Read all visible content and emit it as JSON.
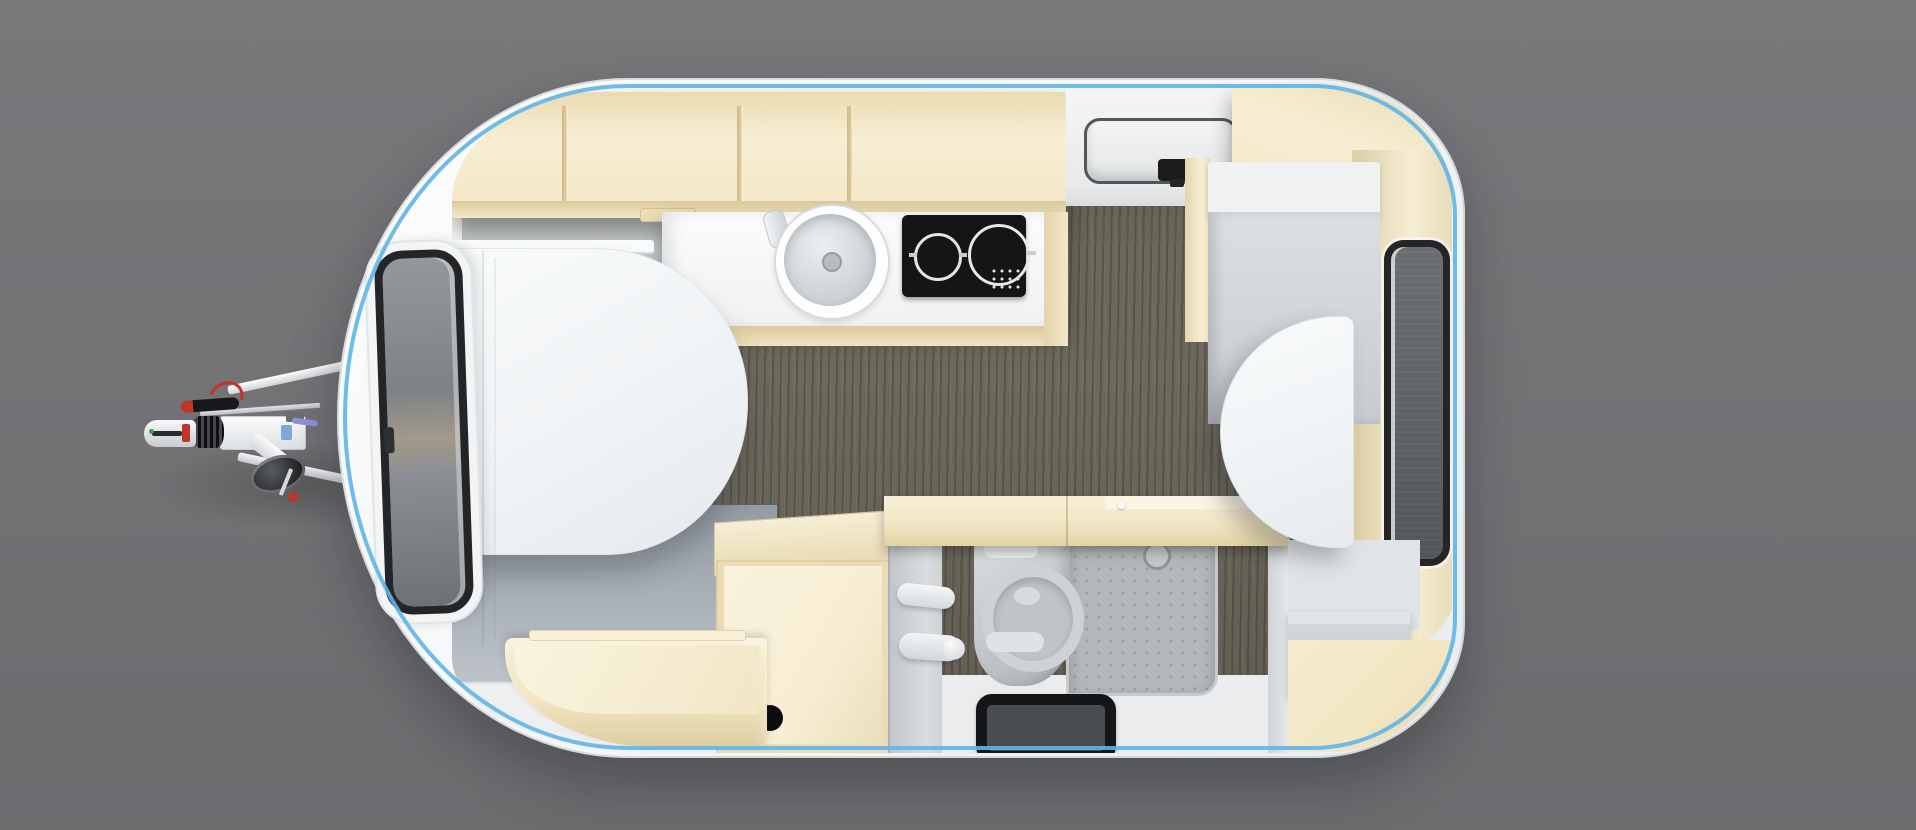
{
  "scene": {
    "title": "Top-down 3D render of a single-axle travel caravan interior floor plan",
    "view": "bird's-eye cutaway",
    "background": "plain gray studio backdrop"
  },
  "colors": {
    "background": "#727275",
    "background_top": "#78787b",
    "background_bottom": "#6c6c6f",
    "body": "#f5f7f8",
    "body_shade": "#e9ecee",
    "trim_blue": "#5fb5e8",
    "cabinet_cream": "#f2e6c3",
    "cabinet_light": "#f7eed4",
    "cabinet_dark": "#dcc99c",
    "floor_wood": "#6b665a",
    "wall_gray": "#c2c6ca",
    "under_bed_gray": "#939ba4",
    "furniture_white": "#f0f3f5",
    "stove_black": "#141517",
    "window_frame": "#232527",
    "window_mesh": "#5e6165",
    "fixture_gray": "#c3c8cc",
    "shower_gray": "#b3b6ba",
    "mat_black": "#141618",
    "accent_red": "#c2342a",
    "label_blue": "#7fa8d9"
  },
  "parts": {
    "caravan_body": "caravan shell with rounded corners and blue awning-rail trim",
    "tow_hitch": "A-frame drawbar with coupling head, handbrake lever and jockey wheel",
    "front_window": "front wall window with dark frame and blind",
    "rear_window": "rear wall window with dark frame and fly screen",
    "overhead_lockers": "open cream overhead storage lockers with dividers",
    "roof_vent": "roof hatch / skylight panel with latch",
    "kitchen": "kitchenette with round sink and two-burner hob",
    "front_bed": "front rounded bed / convertible dinette cushion",
    "rear_table": "rear D-shaped dinette table",
    "rear_seat": "rear bench seat with backrest",
    "washroom": "washroom with cassette toilet, shower tray, drain mat and door handles",
    "wardrobe": "cream wardrobe / storage box with cable grommet",
    "front_shelf": "curved front storage shelf",
    "rear_step": "rear compartment step and cream floor panel",
    "wood_floor": "gray-brown wood plank flooring"
  }
}
